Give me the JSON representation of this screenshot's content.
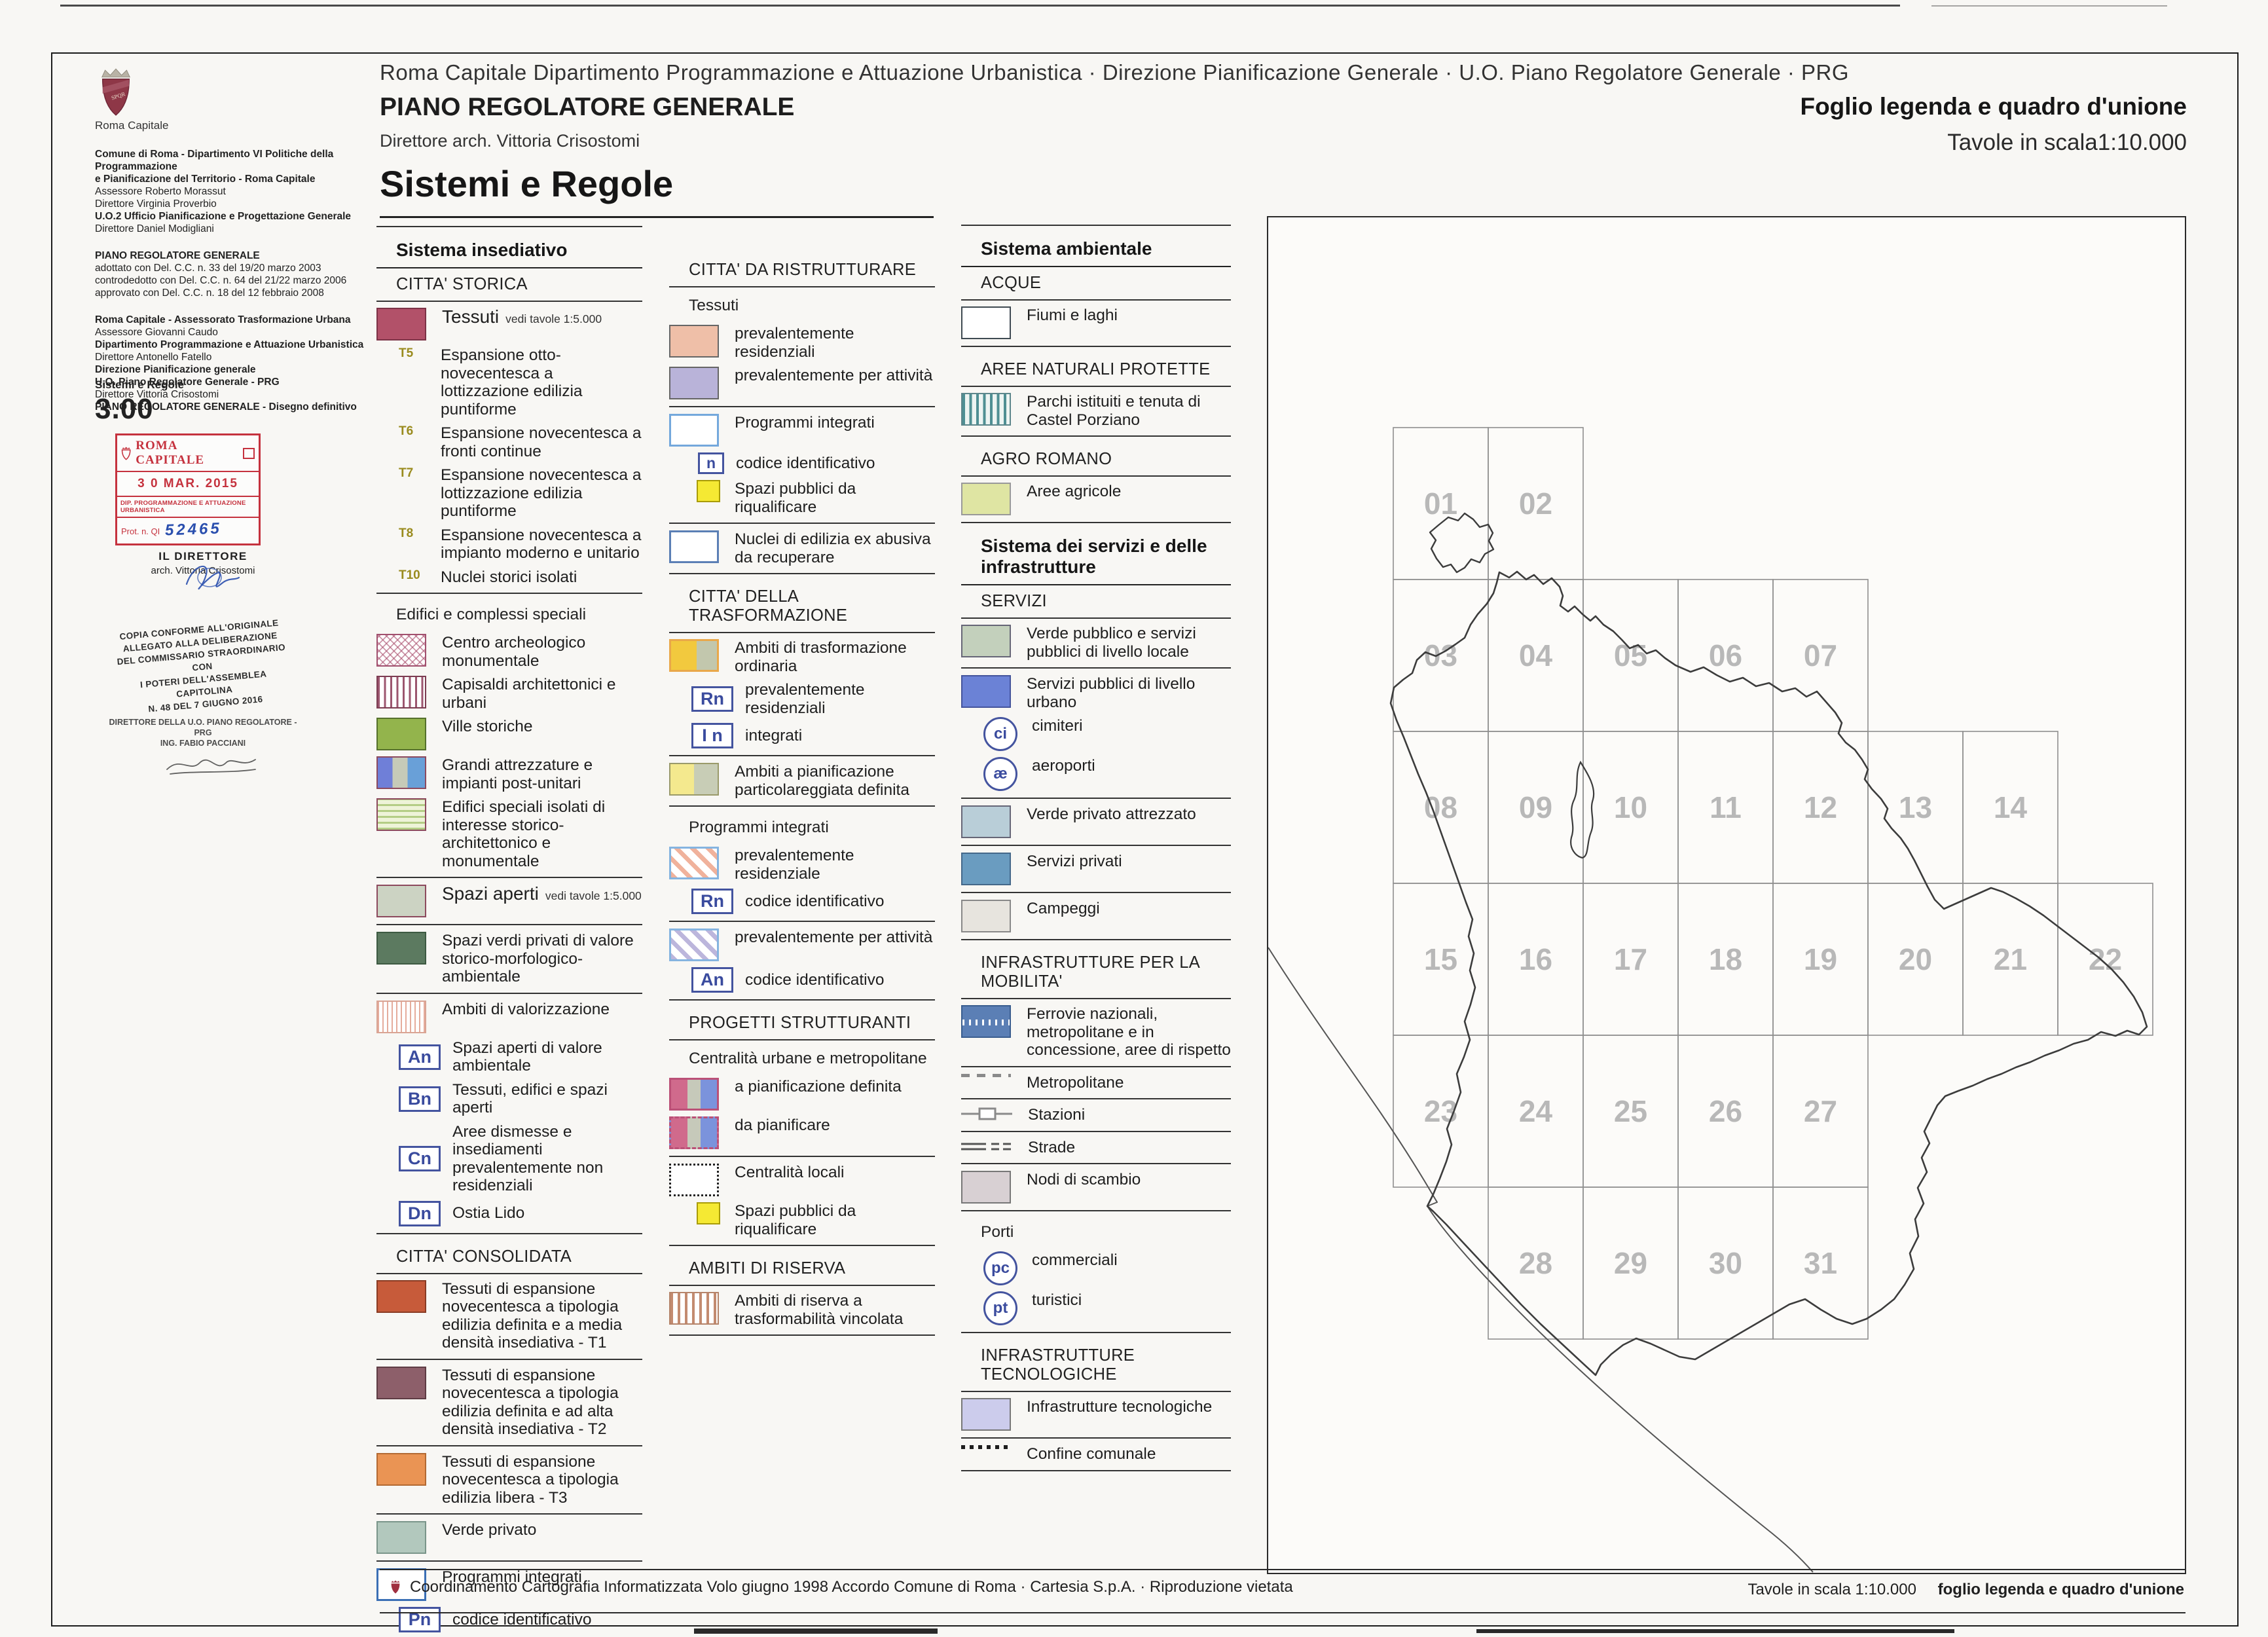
{
  "header": {
    "dept_line": "Roma Capitale  Dipartimento Programmazione e Attuazione Urbanistica · Direzione Pianificazione Generale · U.O. Piano Regolatore Generale · PRG",
    "plan_title": "PIANO REGOLATORE GENERALE",
    "director_line": "Direttore arch. Vittoria Crisostomi",
    "main_title": "Sistemi e Regole",
    "sheet_title": "Foglio legenda e quadro d'unione",
    "sheet_subtitle": "Tavole in scala1:10.000"
  },
  "sidebar": {
    "logo_caption": "Roma Capitale",
    "blocks": [
      {
        "lines": [
          {
            "b": 1,
            "t": "Comune di Roma - Dipartimento VI Politiche della Programmazione"
          },
          {
            "b": 1,
            "t": "e Pianificazione del Territorio - Roma Capitale"
          },
          {
            "b": 0,
            "t": "Assessore Roberto Morassut"
          },
          {
            "b": 0,
            "t": "Direttore Virginia Proverbio"
          },
          {
            "b": 1,
            "t": "U.O.2 Ufficio Pianificazione e Progettazione Generale"
          },
          {
            "b": 0,
            "t": "Direttore Daniel Modigliani"
          }
        ]
      },
      {
        "lines": [
          {
            "b": 1,
            "t": "PIANO REGOLATORE GENERALE"
          },
          {
            "b": 0,
            "t": "adottato con Del. C.C. n. 33 del 19/20 marzo 2003"
          },
          {
            "b": 0,
            "t": "controdedotto con Del. C.C. n. 64 del 21/22 marzo 2006"
          },
          {
            "b": 0,
            "t": "approvato con Del. C.C. n. 18 del 12 febbraio 2008"
          }
        ]
      },
      {
        "lines": [
          {
            "b": 1,
            "t": "Roma Capitale - Assessorato Trasformazione Urbana"
          },
          {
            "b": 0,
            "t": "Assessore Giovanni Caudo"
          },
          {
            "b": 1,
            "t": "Dipartimento Programmazione e Attuazione Urbanistica"
          },
          {
            "b": 0,
            "t": "Direttore Antonello Fatello"
          },
          {
            "b": 1,
            "t": "Direzione Pianificazione generale"
          },
          {
            "b": 1,
            "t": "U.O. Piano Regolatore Generale - PRG"
          },
          {
            "b": 0,
            "t": "Direttore Vittoria Crisostomi"
          },
          {
            "b": 1,
            "t": "PIANO REGOLATORE GENERALE - Disegno definitivo"
          }
        ]
      }
    ],
    "series_label": "Sistemi e Regole",
    "series_number": "3.00",
    "stamp": {
      "title": "ROMA CAPITALE",
      "date": "3 0 MAR. 2015",
      "dept": "DIP. PROGRAMMAZIONE E ATTUAZIONE URBANISTICA",
      "prot_label": "Prot. n. QI",
      "prot_number": "52465"
    },
    "director_stamp": {
      "line1": "IL DIRETTORE",
      "line2": "arch. Vittoria Crisostomi"
    },
    "conformity_stamp": [
      "COPIA CONFORME ALL'ORIGINALE",
      "ALLEGATO ALLA DELIBERAZIONE",
      "DEL COMMISSARIO STRAORDINARIO CON",
      "I POTERI DELL'ASSEMBLEA CAPITOLINA",
      "N. 48  DEL  7  GIUGNO  2016"
    ],
    "signature_stamp": [
      "DIRETTORE DELLA U.O. PIANO REGOLATORE - PRG",
      "ING. FABIO PACCIANI"
    ]
  },
  "legend": {
    "columns": [
      {
        "entries": [
          {
            "k": "div"
          },
          {
            "k": "h1",
            "t": "Sistema insediativo"
          },
          {
            "k": "h2",
            "t": "CITTA' STORICA"
          },
          {
            "k": "item",
            "sw": "tessuti",
            "big": 1,
            "t": "Tessuti",
            "note": "vedi tavole 1:5.000"
          },
          {
            "k": "tcode",
            "c": "T5",
            "t": "Espansione otto-novecentesca a lottizzazione edilizia puntiforme"
          },
          {
            "k": "tcode",
            "c": "T6",
            "t": "Espansione novecentesca a fronti continue"
          },
          {
            "k": "tcode",
            "c": "T7",
            "t": "Espansione novecentesca a lottizzazione edilizia puntiforme"
          },
          {
            "k": "tcode",
            "c": "T8",
            "t": "Espansione novecentesca a impianto moderno e unitario"
          },
          {
            "k": "tcode",
            "c": "T10",
            "t": "Nuclei storici isolati"
          },
          {
            "k": "div"
          },
          {
            "k": "label",
            "t": "Edifici e complessi speciali"
          },
          {
            "k": "item",
            "sw": "centro-archeologico",
            "t": "Centro archeologico monumentale"
          },
          {
            "k": "item",
            "sw": "capisaldi",
            "t": "Capisaldi architettonici e urbani"
          },
          {
            "k": "item",
            "sw": "ville-storiche",
            "t": "Ville storiche"
          },
          {
            "k": "item",
            "sw": "grandi-attrezzature",
            "t": "Grandi attrezzature e impianti post-unitari"
          },
          {
            "k": "item",
            "sw": "edifici-speciali",
            "t": "Edifici speciali isolati di interesse storico-architettonico e monumentale"
          },
          {
            "k": "div"
          },
          {
            "k": "item",
            "sw": "spazi-aperti",
            "big": 1,
            "t": "Spazi aperti",
            "note": "vedi tavole 1:5.000"
          },
          {
            "k": "div"
          },
          {
            "k": "item",
            "sw": "spazi-verdi",
            "t": "Spazi verdi privati di valore storico-morfologico-ambientale"
          },
          {
            "k": "div"
          },
          {
            "k": "item",
            "sw": "ambiti-valorizzazione",
            "t": "Ambiti di valorizzazione"
          },
          {
            "k": "badge",
            "c": "An",
            "t": "Spazi aperti di valore ambientale"
          },
          {
            "k": "badge",
            "c": "Bn",
            "t": "Tessuti, edifici e spazi aperti"
          },
          {
            "k": "badge",
            "c": "Cn",
            "t": "Aree dismesse e insediamenti prevalentemente non residenziali"
          },
          {
            "k": "badge",
            "c": "Dn",
            "t": "Ostia Lido"
          },
          {
            "k": "div"
          },
          {
            "k": "h2",
            "t": "CITTA' CONSOLIDATA"
          },
          {
            "k": "item",
            "sw": "t1",
            "t": "Tessuti di espansione novecentesca a tipologia edilizia definita e a media densità insediativa - T1"
          },
          {
            "k": "div"
          },
          {
            "k": "item",
            "sw": "t2",
            "t": "Tessuti di espansione novecentesca a tipologia edilizia definita e ad alta densità insediativa - T2"
          },
          {
            "k": "div"
          },
          {
            "k": "item",
            "sw": "t3",
            "t": "Tessuti di espansione novecentesca a tipologia edilizia libera - T3"
          },
          {
            "k": "div"
          },
          {
            "k": "item",
            "sw": "verde-privato",
            "t": "Verde privato"
          },
          {
            "k": "div"
          },
          {
            "k": "item",
            "sw": "programmi-integrati",
            "t": "Programmi integrati"
          },
          {
            "k": "badge",
            "c": "Pn",
            "t": "codice identificativo"
          },
          {
            "k": "div"
          }
        ]
      },
      {
        "entries": [
          {
            "k": "h2",
            "t": "CITTA' DA RISTRUTTURARE"
          },
          {
            "k": "label",
            "t": "Tessuti"
          },
          {
            "k": "item",
            "sw": "ristrutturare-residenziali",
            "t": "prevalentemente residenziali"
          },
          {
            "k": "item",
            "sw": "ristrutturare-attivita",
            "t": "prevalentemente per attività"
          },
          {
            "k": "div"
          },
          {
            "k": "item",
            "sw": "programmi-integrati-celeste",
            "t": "Programmi integrati"
          },
          {
            "k": "badge-sm",
            "c": "n",
            "t": "codice identificativo"
          },
          {
            "k": "item-sm",
            "sw": "spazi-pubblici",
            "t": "Spazi pubblici da riqualificare"
          },
          {
            "k": "div"
          },
          {
            "k": "item",
            "sw": "nuclei-abusivi",
            "t": "Nuclei di edilizia ex abusiva da recuperare"
          },
          {
            "k": "div"
          },
          {
            "k": "h2",
            "t": "CITTA' DELLA TRASFORMAZIONE"
          },
          {
            "k": "item",
            "sw": "trasformazione-ordinaria",
            "t": "Ambiti di trasformazione ordinaria"
          },
          {
            "k": "badge",
            "c": "Rn",
            "t": "prevalentemente residenziali"
          },
          {
            "k": "badge",
            "c": "I n",
            "t": "integrati"
          },
          {
            "k": "div"
          },
          {
            "k": "item",
            "sw": "pianificazione-particolareggiata",
            "t": "Ambiti a pianificazione particolareggiata definita"
          },
          {
            "k": "div"
          },
          {
            "k": "label",
            "t": "Programmi integrati"
          },
          {
            "k": "item",
            "sw": "stripes-residenziale",
            "t": "prevalentemente residenziale"
          },
          {
            "k": "badge",
            "c": "Rn",
            "t": "codice identificativo"
          },
          {
            "k": "div"
          },
          {
            "k": "item",
            "sw": "stripes-attivita",
            "t": "prevalentemente per attività"
          },
          {
            "k": "badge",
            "c": "An",
            "t": "codice identificativo"
          },
          {
            "k": "div"
          },
          {
            "k": "h2",
            "t": "PROGETTI STRUTTURANTI"
          },
          {
            "k": "label",
            "t": "Centralità urbane e metropolitane"
          },
          {
            "k": "item",
            "sw": "centralita-definita",
            "t": "a pianificazione definita"
          },
          {
            "k": "item",
            "sw": "centralita-da-pianificare",
            "t": "da pianificare"
          },
          {
            "k": "div"
          },
          {
            "k": "item",
            "sw": "centralita-locali",
            "t": "Centralità locali"
          },
          {
            "k": "item-sm",
            "sw": "spazi-pubblici",
            "t": "Spazi pubblici da riqualificare"
          },
          {
            "k": "div"
          },
          {
            "k": "h2",
            "t": "AMBITI DI RISERVA"
          },
          {
            "k": "item",
            "sw": "ambiti-riserva",
            "t": "Ambiti di riserva a trasformabilità vincolata"
          },
          {
            "k": "div"
          }
        ]
      },
      {
        "entries": [
          {
            "k": "div"
          },
          {
            "k": "h1",
            "t": "Sistema ambientale"
          },
          {
            "k": "h2",
            "t": "ACQUE"
          },
          {
            "k": "item",
            "sw": "fiumi-laghi",
            "t": "Fiumi e laghi"
          },
          {
            "k": "div"
          },
          {
            "k": "h2",
            "t": "AREE NATURALI PROTETTE"
          },
          {
            "k": "item",
            "sw": "parchi",
            "t": "Parchi istituiti e tenuta di Castel Porziano"
          },
          {
            "k": "div"
          },
          {
            "k": "h2",
            "t": "AGRO ROMANO"
          },
          {
            "k": "item",
            "sw": "aree-agricole",
            "t": "Aree agricole"
          },
          {
            "k": "div"
          },
          {
            "k": "h1",
            "t": "Sistema dei servizi e delle infrastrutture"
          },
          {
            "k": "h2",
            "t": "SERVIZI"
          },
          {
            "k": "item",
            "sw": "verde-pubblico",
            "t": "Verde pubblico e servizi pubblici di livello locale"
          },
          {
            "k": "div"
          },
          {
            "k": "item",
            "sw": "servizi-urbani",
            "t": "Servizi pubblici di livello urbano"
          },
          {
            "k": "circle",
            "c": "ci",
            "t": "cimiteri"
          },
          {
            "k": "circle",
            "c": "æ",
            "t": "aeroporti"
          },
          {
            "k": "div"
          },
          {
            "k": "item",
            "sw": "verde-attrezzato",
            "t": "Verde privato attrezzato"
          },
          {
            "k": "div"
          },
          {
            "k": "item",
            "sw": "servizi-privati",
            "t": "Servizi privati"
          },
          {
            "k": "div"
          },
          {
            "k": "item",
            "sw": "campeggi",
            "t": "Campeggi"
          },
          {
            "k": "div"
          },
          {
            "k": "h2",
            "t": "INFRASTRUTTURE PER LA MOBILITA'"
          },
          {
            "k": "item",
            "sw": "ferrovie",
            "t": "Ferrovie nazionali, metropolitane e in concessione, aree di rispetto"
          },
          {
            "k": "div"
          },
          {
            "k": "line",
            "sw": "metropolitane",
            "t": "Metropolitane"
          },
          {
            "k": "div"
          },
          {
            "k": "line",
            "sw": "stazioni",
            "t": "Stazioni"
          },
          {
            "k": "div"
          },
          {
            "k": "line",
            "sw": "strade",
            "t": "Strade"
          },
          {
            "k": "div"
          },
          {
            "k": "item",
            "sw": "nodi-scambio",
            "t": "Nodi di scambio"
          },
          {
            "k": "div"
          },
          {
            "k": "label",
            "t": "Porti"
          },
          {
            "k": "circle",
            "c": "pc",
            "t": "commerciali"
          },
          {
            "k": "circle",
            "c": "pt",
            "t": "turistici"
          },
          {
            "k": "div"
          },
          {
            "k": "h2",
            "t": "INFRASTRUTTURE TECNOLOGICHE"
          },
          {
            "k": "item",
            "sw": "infrastrutture-tecnologiche",
            "t": "Infrastrutture tecnologiche"
          },
          {
            "k": "div"
          },
          {
            "k": "line",
            "sw": "confine-comunale",
            "t": "Confine comunale"
          },
          {
            "k": "div"
          }
        ]
      }
    ]
  },
  "map": {
    "tiles": [
      {
        "n": "01",
        "c": 0,
        "r": 0
      },
      {
        "n": "02",
        "c": 1,
        "r": 0
      },
      {
        "n": "03",
        "c": 0,
        "r": 1
      },
      {
        "n": "04",
        "c": 1,
        "r": 1
      },
      {
        "n": "05",
        "c": 2,
        "r": 1
      },
      {
        "n": "06",
        "c": 3,
        "r": 1
      },
      {
        "n": "07",
        "c": 4,
        "r": 1
      },
      {
        "n": "08",
        "c": 0,
        "r": 2
      },
      {
        "n": "09",
        "c": 1,
        "r": 2
      },
      {
        "n": "10",
        "c": 2,
        "r": 2
      },
      {
        "n": "11",
        "c": 3,
        "r": 2
      },
      {
        "n": "12",
        "c": 4,
        "r": 2
      },
      {
        "n": "13",
        "c": 5,
        "r": 2
      },
      {
        "n": "14",
        "c": 6,
        "r": 2
      },
      {
        "n": "15",
        "c": 0,
        "r": 3
      },
      {
        "n": "16",
        "c": 1,
        "r": 3
      },
      {
        "n": "17",
        "c": 2,
        "r": 3
      },
      {
        "n": "18",
        "c": 3,
        "r": 3
      },
      {
        "n": "19",
        "c": 4,
        "r": 3
      },
      {
        "n": "20",
        "c": 5,
        "r": 3
      },
      {
        "n": "21",
        "c": 6,
        "r": 3
      },
      {
        "n": "22",
        "c": 7,
        "r": 3
      },
      {
        "n": "23",
        "c": 0,
        "r": 4
      },
      {
        "n": "24",
        "c": 1,
        "r": 4
      },
      {
        "n": "25",
        "c": 2,
        "r": 4
      },
      {
        "n": "26",
        "c": 3,
        "r": 4
      },
      {
        "n": "27",
        "c": 4,
        "r": 4
      },
      {
        "n": "28",
        "c": 1,
        "r": 5
      },
      {
        "n": "29",
        "c": 2,
        "r": 5
      },
      {
        "n": "30",
        "c": 3,
        "r": 5
      },
      {
        "n": "31",
        "c": 4,
        "r": 5
      }
    ]
  },
  "footer": {
    "left_text": "Coordinamento Cartografia Informatizzata  Volo giugno 1998    Accordo Comune di Roma · Cartesia S.p.A. · Riproduzione vietata",
    "right_scale": "Tavole in scala 1:10.000",
    "right_title": "foglio legenda e quadro d'unione"
  },
  "colors": {
    "stamp_red": "#c5323e",
    "signature_blue": "#2a4fae",
    "tile_number_gray": "#b8b8b8",
    "badge_blue": "#44549f",
    "tessuti_rose": "#b25169"
  }
}
